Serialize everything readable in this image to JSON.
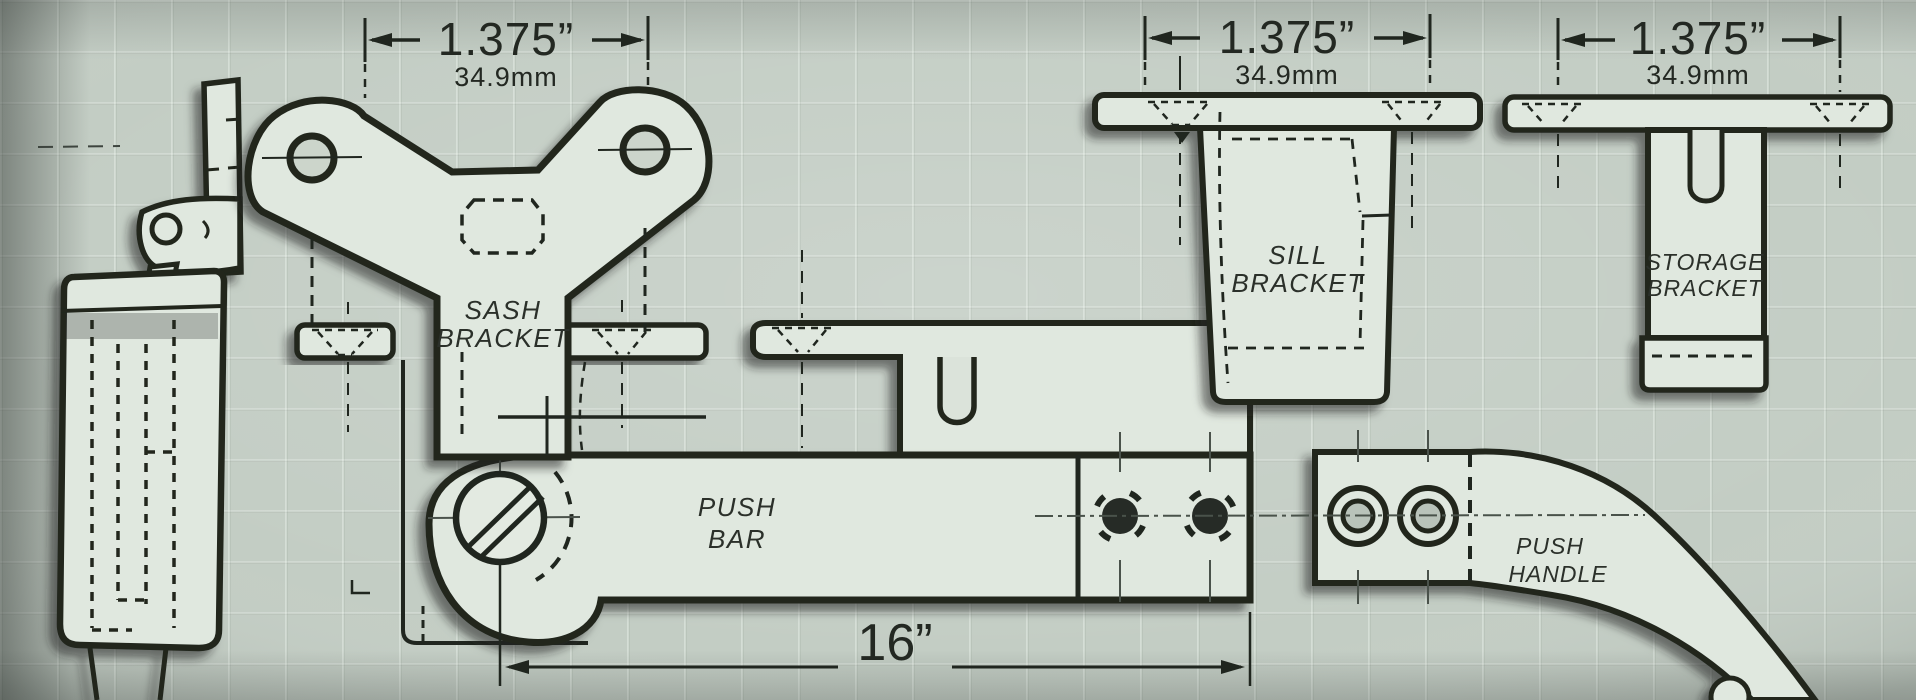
{
  "diagram": {
    "description": "Technical line drawing of casement window hardware parts",
    "colors": {
      "background": "#c3cdc4",
      "part_fill": "#e0e8df",
      "line": "#20261f"
    },
    "dimensions": {
      "sash_width_in": "1.375”",
      "sash_width_mm": "34.9mm",
      "sill_width_in": "1.375”",
      "sill_width_mm": "34.9mm",
      "storage_width_in": "1.375”",
      "storage_width_mm": "34.9mm",
      "push_bar_length_in": "16”"
    },
    "parts": {
      "sash_bracket": {
        "line1": "SASH",
        "line2": "BRACKET"
      },
      "push_bar": {
        "line1": "PUSH",
        "line2": "BAR"
      },
      "sill_bracket": {
        "line1": "SILL",
        "line2": "BRACKET"
      },
      "storage_bracket": {
        "line1": "STORAGE",
        "line2": "BRACKET"
      },
      "push_handle": {
        "line1": "PUSH",
        "line2": "HANDLE"
      }
    }
  }
}
